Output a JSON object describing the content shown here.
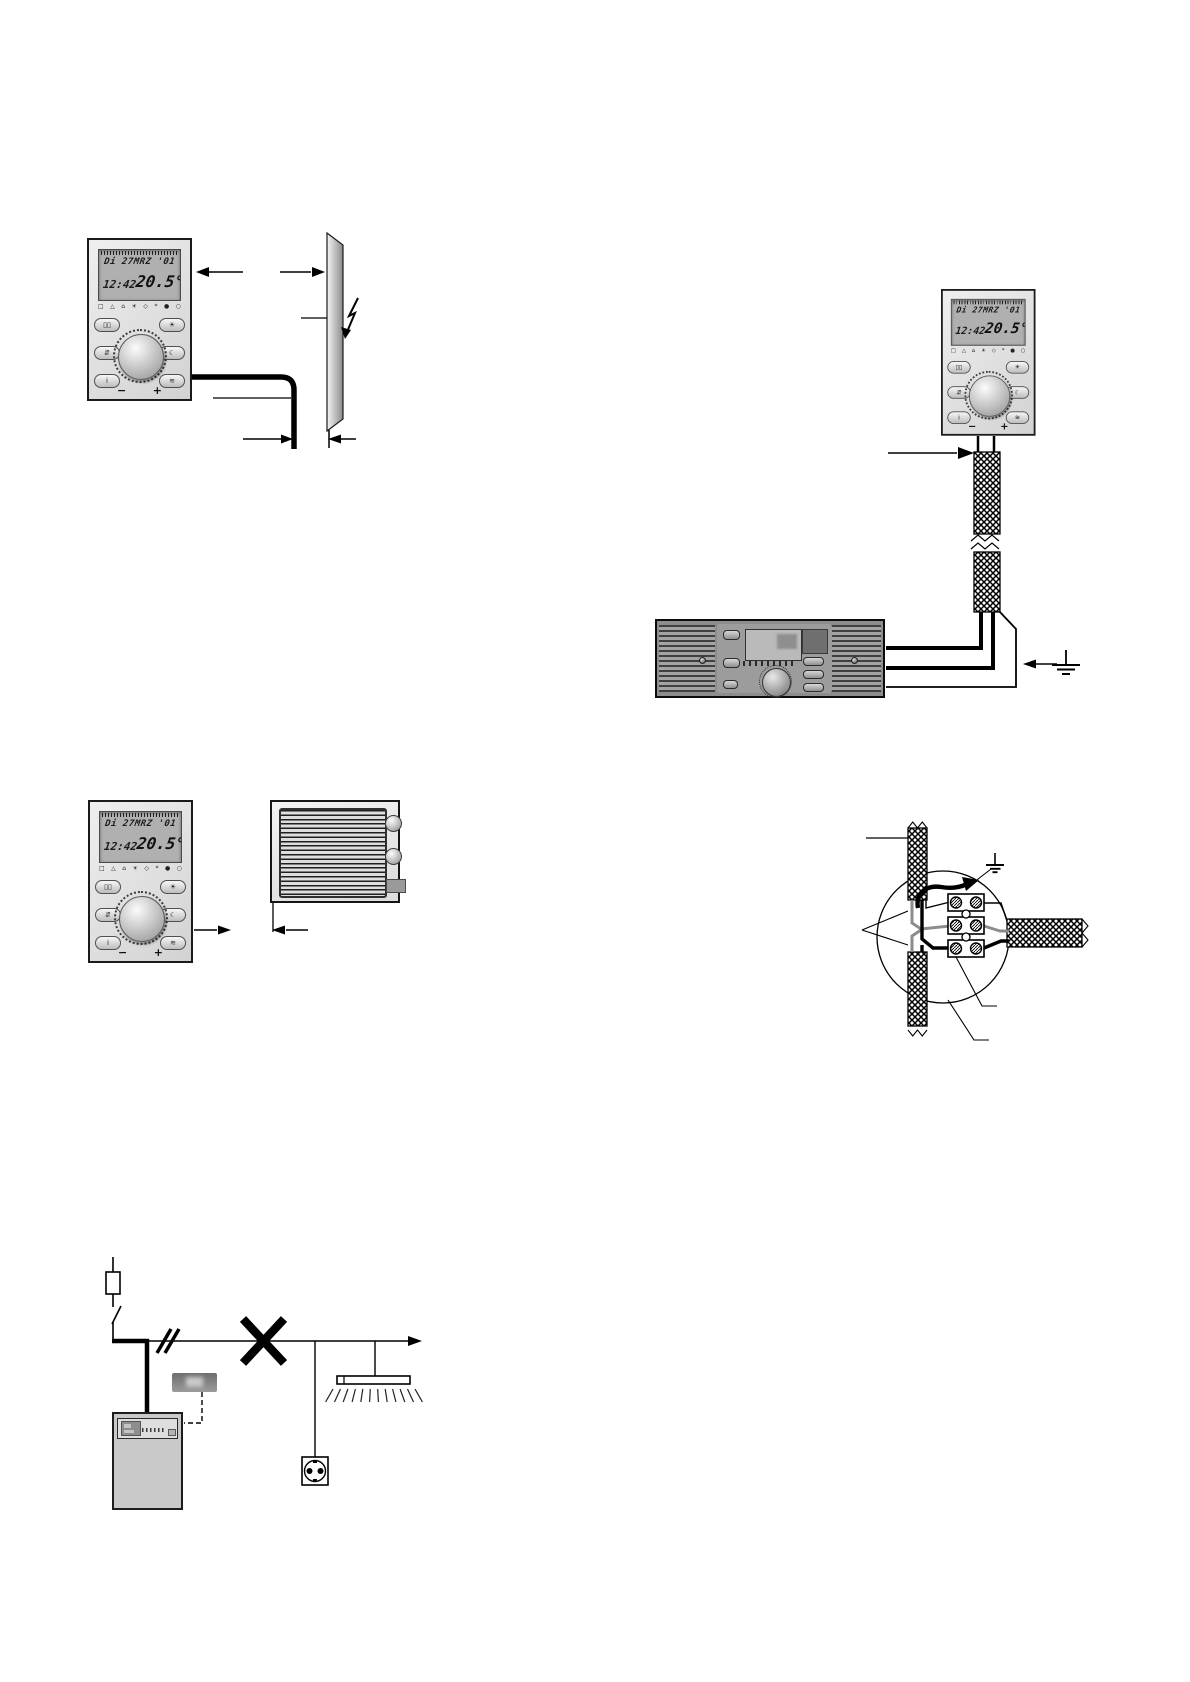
{
  "page": {
    "background": "#ffffff"
  },
  "colors": {
    "line": "#000000",
    "device_body": "#e3e3e3",
    "lcd_background": "#b0b0b0",
    "boiler_panel": "#8d8d8d",
    "wire_gray": "#8c8c8c",
    "heater_body": "#ececec"
  },
  "room_controller": {
    "lcd": {
      "date_line": "Di 27MRZ '01",
      "time": "12:42",
      "temperature": "20.5",
      "degree_mark": "°"
    },
    "status_icons": [
      "□",
      "△",
      "⌂",
      "☀",
      "◇",
      "*",
      "●",
      "○"
    ],
    "buttons_left": [
      "▯▯",
      "⇵",
      "i"
    ],
    "buttons_right": [
      "☀",
      "☾",
      "≋"
    ],
    "dial_minus": "−",
    "dial_plus": "+"
  }
}
